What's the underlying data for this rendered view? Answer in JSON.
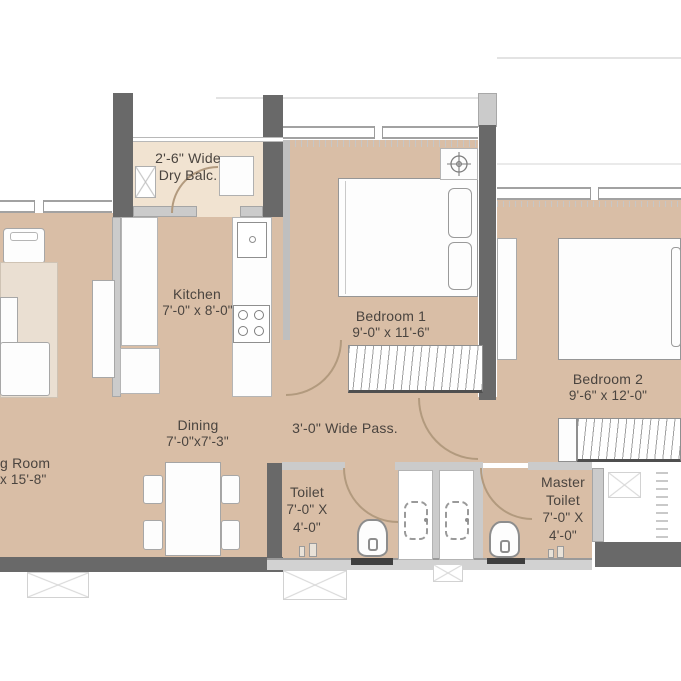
{
  "rooms": {
    "dry_balcony": {
      "line1": "2'-6\" Wide",
      "line2": "Dry Balc."
    },
    "kitchen": {
      "name": "Kitchen",
      "dims": "7'-0\" x 8'-0\""
    },
    "bedroom1": {
      "name": "Bedroom 1",
      "dims": "9'-0\" x 11'-6\""
    },
    "bedroom2": {
      "name": "Bedroom 2",
      "dims": "9'-6\" x 12'-0\""
    },
    "dining": {
      "name": "Dining",
      "dims": "7'-0\"x7'-3\""
    },
    "living_room": {
      "name_visible": "g Room",
      "dims_visible": "x 15'-8\""
    },
    "passage": {
      "name": "3'-0\" Wide Pass."
    },
    "toilet": {
      "name": "Toilet",
      "dims_line1": "7'-0\" X",
      "dims_line2": "4'-0\""
    },
    "master_toilet": {
      "name_line1": "Master",
      "name_line2": "Toilet",
      "dims_line1": "7'-0\" X",
      "dims_line2": "4'-0\""
    }
  },
  "colors": {
    "floor_tan": "#d9bea6",
    "balcony_floor": "#f1e3d1",
    "wall_dark": "#696969",
    "wall_light": "#cbcbcb",
    "furniture_fill": "#fdfdfd",
    "door_arc_line": "#b29a7e",
    "label_text": "#4a443f",
    "rug": "#eadfd2"
  },
  "icons": {
    "ceiling_fan": "circle-crosshair",
    "washing_machine": "box-with-x",
    "duct": "box-with-x",
    "shower_area": "dashed-rounded-square",
    "wardrobe_fill": "vertical-hatch"
  }
}
